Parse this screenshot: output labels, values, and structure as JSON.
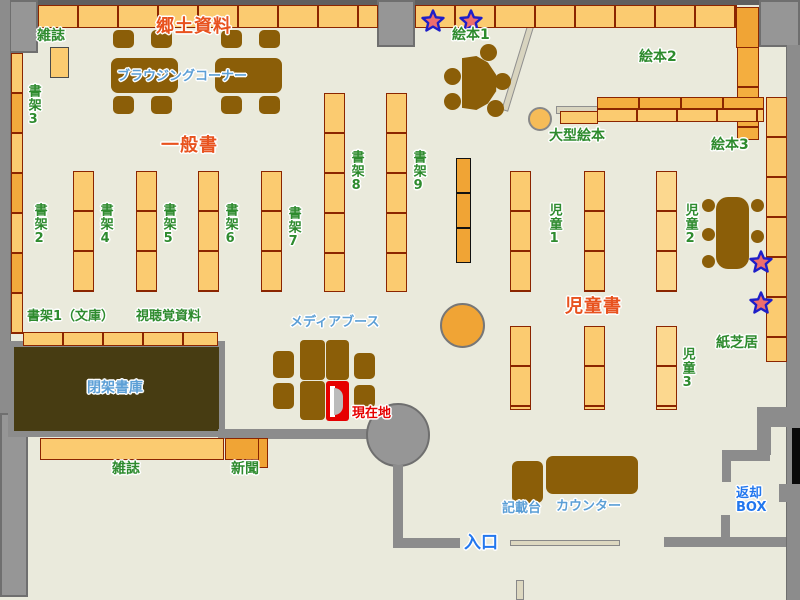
{
  "map_title": "library-floor-map",
  "labels": {
    "magazines_top": "雑誌",
    "local_materials": "郷土資料",
    "browsing_corner": "ブラウジングコーナー",
    "general_books": "一般書",
    "picture_books1": "絵本1",
    "picture_books2": "絵本2",
    "picture_books3": "絵本3",
    "large_picture_books": "大型絵本",
    "shelf2": "書架2",
    "shelf3": "書架3",
    "shelf4": "書架4",
    "shelf5": "書架5",
    "shelf6": "書架6",
    "shelf7": "書架7",
    "shelf8": "書架8",
    "shelf9": "書架9",
    "children1": "児童1",
    "children2": "児童2",
    "children3": "児童3",
    "shelf1_bunko": "書架1（文庫）",
    "audiovisual": "視聴覚資料",
    "media_booth": "メディアブース",
    "current_location": "現在地",
    "children_books": "児童書",
    "kamishibai": "紙芝居",
    "closed_stacks": "閉架書庫",
    "magazines_bottom": "雑誌",
    "newspapers": "新聞",
    "entrance": "入口",
    "writing_stand": "記載台",
    "counter": "カウンター",
    "return_box_line1": "返却",
    "return_box_line2": "BOX"
  },
  "markers": {
    "star_count": 4,
    "star_fill": "#ED6E6E",
    "star_outline": "#1E1EC8",
    "current_location_color": "#E60000"
  },
  "colors": {
    "floor": "#EAEADC",
    "shelf_light": "#FBCB70",
    "shelf_dark": "#F0A435",
    "shelf_border": "#8B2500",
    "furniture_brown": "#8B5E08",
    "wall_gray": "#969696",
    "closed_stacks_brown": "#473C12",
    "label_green": "#2E8B2E",
    "label_area_orange": "#E8521E",
    "label_lightblue": "#5C9FD6",
    "label_blue": "#2277EE"
  }
}
